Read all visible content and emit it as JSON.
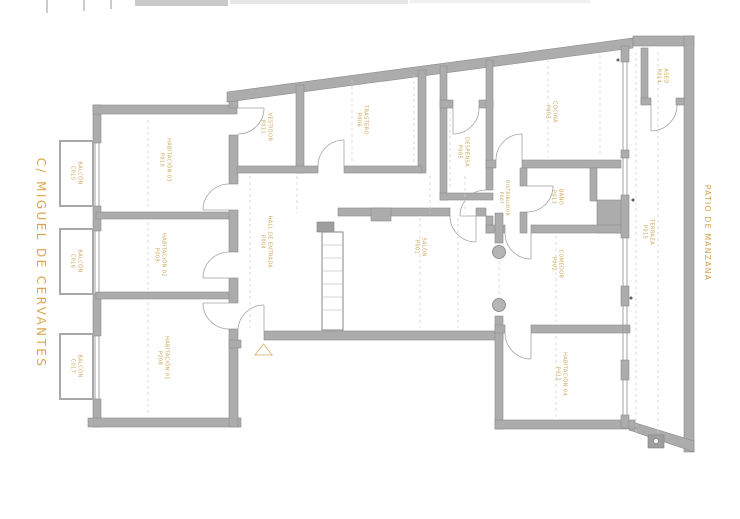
{
  "plan": {
    "street_label": "C/ MIGUEL DE CERVANTES",
    "patio_label": "PATIO DE MANZANA",
    "accent_color": "#D2A24C",
    "wall_color": "#ACACAC",
    "rooms": [
      {
        "name": "HABITACIÓN 03",
        "code": "P010"
      },
      {
        "name": "HABITACIÓN 02",
        "code": "P009"
      },
      {
        "name": "HABITACIÓN 01",
        "code": "P008"
      },
      {
        "name": "VESTIDOR",
        "code": "P011"
      },
      {
        "name": "TRASTERO",
        "code": "P006"
      },
      {
        "name": "DESPENSA",
        "code": "P005"
      },
      {
        "name": "COCINA",
        "code": "P003"
      },
      {
        "name": "DISTRIBUIDOR",
        "code": "P007"
      },
      {
        "name": "BAÑO",
        "code": "P013"
      },
      {
        "name": "ASEO",
        "code": "P014"
      },
      {
        "name": "TERRAZA",
        "code": "P015"
      },
      {
        "name": "HALL DE ENTRADA",
        "code": "P004"
      },
      {
        "name": "SALÓN",
        "code": "P001"
      },
      {
        "name": "COMEDOR",
        "code": "P002"
      },
      {
        "name": "HABITACIÓN 04",
        "code": "P012"
      }
    ],
    "balconies": [
      {
        "name": "BALCÓN",
        "code": "C015"
      },
      {
        "name": "BALCÓN",
        "code": "C016"
      },
      {
        "name": "BALCÓN",
        "code": "C017"
      }
    ]
  }
}
